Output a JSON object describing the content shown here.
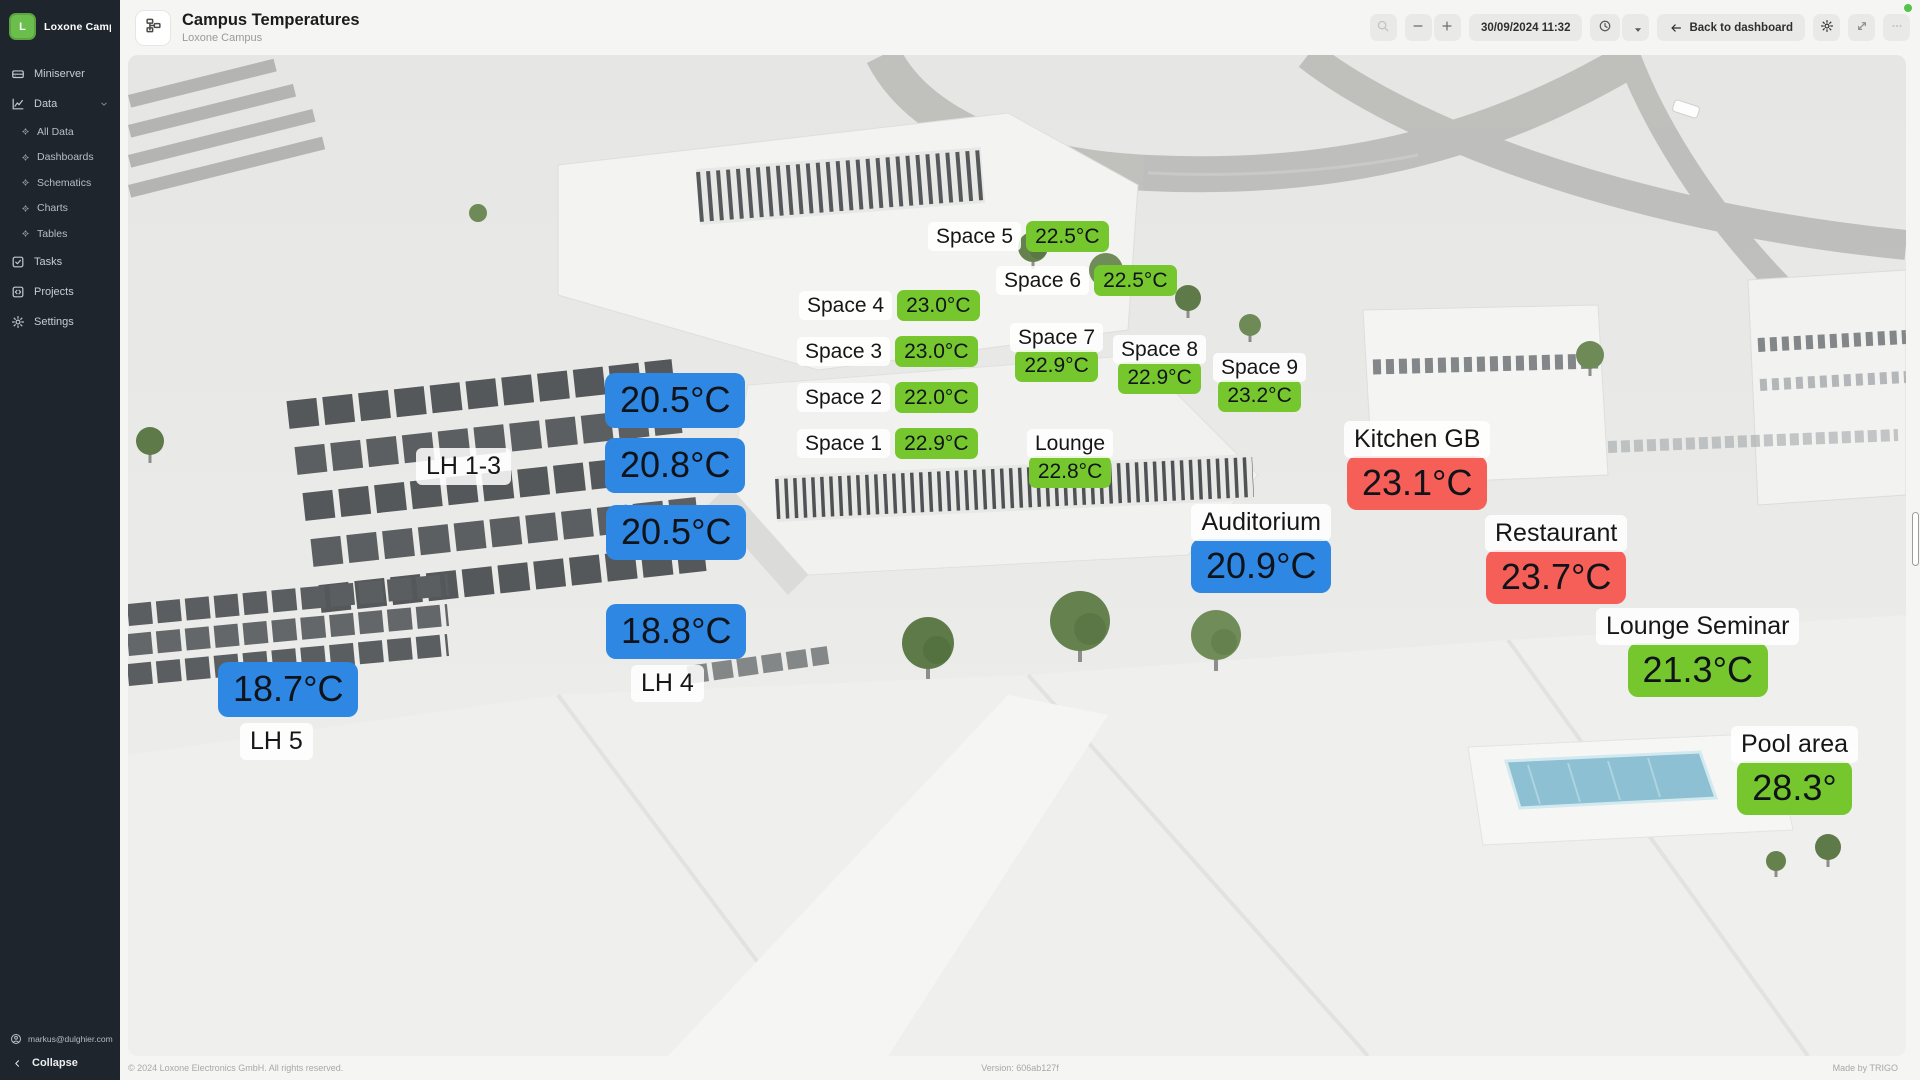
{
  "app": {
    "workspace": {
      "initial": "L",
      "name": "Loxone Campus..."
    },
    "status_dot_color": "#55c24a"
  },
  "sidebar": {
    "items": [
      {
        "label": "Miniserver",
        "icon": "miniserver-icon"
      },
      {
        "label": "Data",
        "icon": "data-icon",
        "expanded": true,
        "children": [
          {
            "label": "All Data"
          },
          {
            "label": "Dashboards"
          },
          {
            "label": "Schematics"
          },
          {
            "label": "Charts"
          },
          {
            "label": "Tables"
          }
        ]
      },
      {
        "label": "Tasks",
        "icon": "tasks-icon"
      },
      {
        "label": "Projects",
        "icon": "projects-icon"
      },
      {
        "label": "Settings",
        "icon": "settings-icon"
      }
    ],
    "user_email": "markus@dulghier.com",
    "collapse_label": "Collapse"
  },
  "header": {
    "title": "Campus Temperatures",
    "subtitle": "Loxone Campus"
  },
  "toolbar": {
    "datetime": "30/09/2024 11:32",
    "back_label": "Back to dashboard"
  },
  "canvas": {
    "colors": {
      "green": "#76C72E",
      "blue": "#2E87E2",
      "red": "#F55F58"
    },
    "markers": [
      {
        "name": "Space 5",
        "value": "22.5°C",
        "color": "green",
        "layout": "inline",
        "size": "sm",
        "x": 800,
        "y": 166
      },
      {
        "name": "Space 6",
        "value": "22.5°C",
        "color": "green",
        "layout": "inline",
        "size": "sm",
        "x": 868,
        "y": 210
      },
      {
        "name": "Space 4",
        "value": "23.0°C",
        "color": "green",
        "layout": "inline",
        "size": "sm",
        "x": 671,
        "y": 235
      },
      {
        "name": "Space 3",
        "value": "23.0°C",
        "color": "green",
        "layout": "inline",
        "size": "sm",
        "x": 669,
        "y": 281
      },
      {
        "name": "Space 2",
        "value": "22.0°C",
        "color": "green",
        "layout": "inline",
        "size": "sm",
        "x": 669,
        "y": 327
      },
      {
        "name": "Space 1",
        "value": "22.9°C",
        "color": "green",
        "layout": "inline",
        "size": "sm",
        "x": 669,
        "y": 373
      },
      {
        "name": "Space 7",
        "value": "22.9°C",
        "color": "green",
        "layout": "stacked",
        "size": "sm",
        "x": 882,
        "y": 268
      },
      {
        "name": "Space 8",
        "value": "22.9°C",
        "color": "green",
        "layout": "stacked",
        "size": "sm",
        "x": 985,
        "y": 280
      },
      {
        "name": "Space 9",
        "value": "23.2°C",
        "color": "green",
        "layout": "stacked",
        "size": "sm",
        "x": 1085,
        "y": 298
      },
      {
        "name": "Lounge",
        "value": "22.8°C",
        "color": "green",
        "layout": "stacked",
        "size": "sm",
        "x": 899,
        "y": 374
      },
      {
        "name": "Kitchen GB",
        "value": "23.1°C",
        "color": "red",
        "layout": "stacked",
        "size": "lg",
        "x": 1216,
        "y": 366
      },
      {
        "name": "Auditorium",
        "value": "20.9°C",
        "color": "blue",
        "layout": "stacked",
        "size": "lg",
        "x": 1063,
        "y": 449
      },
      {
        "name": "Restaurant",
        "value": "23.7°C",
        "color": "red",
        "layout": "stacked",
        "size": "lg",
        "x": 1357,
        "y": 460
      },
      {
        "name": "Lounge Seminar",
        "value": "21.3°C",
        "color": "green",
        "layout": "stacked",
        "size": "lg",
        "x": 1468,
        "y": 553
      },
      {
        "name": "Pool area",
        "value": "28.3°",
        "color": "green",
        "layout": "stacked",
        "size": "lg",
        "x": 1603,
        "y": 671
      },
      {
        "name": "LH 1-3",
        "layout": "name-only",
        "size": "lg",
        "x": 288,
        "y": 393
      },
      {
        "value": "20.5°C",
        "color": "blue",
        "layout": "value-only",
        "size": "lg",
        "x": 477,
        "y": 318
      },
      {
        "value": "20.8°C",
        "color": "blue",
        "layout": "value-only",
        "size": "lg",
        "x": 477,
        "y": 383
      },
      {
        "value": "20.5°C",
        "color": "blue",
        "layout": "value-only",
        "size": "lg",
        "x": 478,
        "y": 450
      },
      {
        "value": "18.8°C",
        "color": "blue",
        "layout": "value-only",
        "size": "lg",
        "x": 478,
        "y": 549
      },
      {
        "name": "LH 4",
        "layout": "name-only",
        "size": "lg",
        "x": 503,
        "y": 610
      },
      {
        "value": "18.7°C",
        "color": "blue",
        "layout": "value-only",
        "size": "lg",
        "x": 90,
        "y": 607
      },
      {
        "name": "LH 5",
        "layout": "name-only",
        "size": "lg",
        "x": 112,
        "y": 668
      }
    ]
  },
  "page_footer": {
    "copyright": "© 2024 Loxone Electronics GmbH. All rights reserved.",
    "version": "Version: 606ab127f",
    "made_by": "Made by TRIGO"
  }
}
